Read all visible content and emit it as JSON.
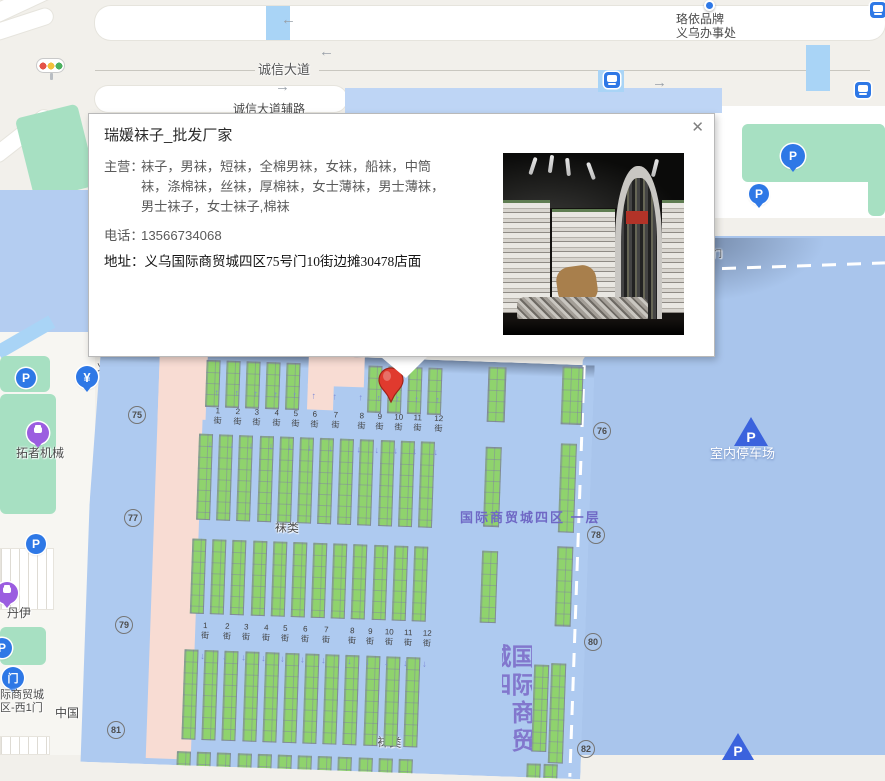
{
  "popup": {
    "title": "瑞媛袜子_批发厂家",
    "close_label": "✕",
    "fields": [
      {
        "label": "主营：",
        "value": "袜子，男袜，短袜，全棉男袜，女袜，船袜，中筒袜，涤棉袜，丝袜，厚棉袜，女士薄袜，男士薄袜，男士袜子，女士袜子,棉袜"
      },
      {
        "label": "电话：",
        "value": "13566734068"
      },
      {
        "label": "地址：",
        "value": "义乌国际商贸城四区75号门10街边摊30478店面"
      }
    ]
  },
  "map": {
    "streets": {
      "suffix": "街",
      "nums": [
        "1",
        "2",
        "3",
        "4",
        "5",
        "6",
        "7",
        "8",
        "9",
        "10",
        "11",
        "12"
      ],
      "rows": [
        {
          "v": 54,
          "us": [
            124,
            144,
            163,
            183,
            202,
            221,
            242,
            268,
            286,
            305,
            324,
            345
          ]
        },
        {
          "v": 269,
          "us": [
            119,
            141,
            160,
            180,
            199,
            219,
            240,
            266,
            284,
            303,
            322,
            341
          ]
        }
      ]
    },
    "street_arrows": [
      {
        "v": 36,
        "dir": "↑",
        "us": [
          124,
          144,
          163,
          183,
          202,
          221,
          242,
          268,
          286,
          305,
          324,
          345
        ]
      },
      {
        "v": 88,
        "dir": "↓",
        "us": [
          119,
          141,
          160,
          180,
          199,
          219,
          240,
          268,
          286,
          305,
          324,
          345
        ]
      },
      {
        "v": 300,
        "dir": "↓",
        "us": [
          119,
          141,
          160,
          180,
          199,
          219,
          240,
          266,
          284,
          303,
          322,
          341
        ]
      }
    ],
    "stall_bands": [
      {
        "v": 8,
        "h": 47,
        "w": 14,
        "cols": [
          112,
          132,
          152,
          172,
          192,
          274,
          294,
          314,
          334
        ]
      },
      {
        "v": 5,
        "h": 55,
        "w": 18,
        "cols": [
          394
        ]
      },
      {
        "v": 2,
        "h": 58,
        "w": 21,
        "cols": [
          468
        ]
      },
      {
        "v": 82,
        "h": 86,
        "w": 14,
        "cols": [
          107,
          127,
          147,
          168,
          188,
          208,
          228,
          248,
          268,
          289,
          309,
          329
        ]
      },
      {
        "v": 85,
        "h": 80,
        "w": 16,
        "cols": [
          394
        ]
      },
      {
        "v": 79,
        "h": 89,
        "w": 16,
        "cols": [
          469
        ]
      },
      {
        "v": 187,
        "h": 75,
        "w": 14,
        "cols": [
          104,
          124,
          144,
          165,
          185,
          205,
          225,
          245,
          265,
          286,
          306,
          326
        ]
      },
      {
        "v": 189,
        "h": 72,
        "w": 16,
        "cols": [
          394
        ]
      },
      {
        "v": 182,
        "h": 80,
        "w": 16,
        "cols": [
          469
        ]
      },
      {
        "v": 298,
        "h": 90,
        "w": 14,
        "cols": [
          100,
          120,
          140,
          161,
          181,
          201,
          221,
          241,
          261,
          282,
          302,
          322
        ]
      },
      {
        "v": 301,
        "h": 87,
        "w": 15,
        "cols": [
          450
        ]
      },
      {
        "v": 299,
        "h": 100,
        "w": 15,
        "cols": [
          467
        ]
      },
      {
        "v": 400,
        "h": 16,
        "w": 14,
        "cols": [
          96,
          116,
          136,
          157,
          177,
          197,
          217,
          237,
          257,
          278,
          298,
          318,
          446,
          463
        ]
      }
    ],
    "gates": [
      {
        "n": "75",
        "x": 128,
        "y": 406
      },
      {
        "n": "76",
        "x": 593,
        "y": 422
      },
      {
        "n": "77",
        "x": 124,
        "y": 509
      },
      {
        "n": "78",
        "x": 587,
        "y": 526
      },
      {
        "n": "79",
        "x": 115,
        "y": 616
      },
      {
        "n": "80",
        "x": 584,
        "y": 633
      },
      {
        "n": "81",
        "x": 107,
        "y": 721
      },
      {
        "n": "82",
        "x": 577,
        "y": 740
      }
    ],
    "features": [
      {
        "l": "u",
        "t": "road",
        "b": [
          95,
          6,
          790,
          34
        ],
        "name": "road-chengxin-avenue"
      },
      {
        "l": "u",
        "t": "crossing",
        "b": [
          266,
          6,
          24,
          34
        ],
        "name": "crosswalk"
      },
      {
        "l": "u",
        "t": "roadline",
        "b": [
          95,
          70,
          775,
          1
        ],
        "name": "road-centerline"
      },
      {
        "l": "u",
        "t": "road",
        "b": [
          95,
          86,
          252,
          26
        ],
        "name": "road-frontage"
      },
      {
        "l": "u",
        "t": "road",
        "b": [
          -14,
          -8,
          74,
          18
        ],
        "rot": -25,
        "name": "road-fragment"
      },
      {
        "l": "u",
        "t": "road",
        "b": [
          -10,
          16,
          64,
          16
        ],
        "rot": -18,
        "name": "road-fragment"
      },
      {
        "l": "u",
        "t": "road",
        "b": [
          -16,
          128,
          74,
          16
        ],
        "rot": -38,
        "name": "road-fragment"
      },
      {
        "l": "u",
        "t": "green",
        "b": [
          24,
          110,
          64,
          84
        ],
        "rot": -14,
        "name": "park-area"
      },
      {
        "l": "u",
        "t": "bldgL",
        "b": [
          0,
          190,
          88,
          143
        ],
        "name": "building-west"
      },
      {
        "l": "u",
        "t": "strip",
        "b": [
          0,
          332,
          95,
          423
        ],
        "name": "west-road-strip"
      },
      {
        "l": "u",
        "t": "crossing",
        "b": [
          -6,
          330,
          62,
          14
        ],
        "rot": -30,
        "name": "crosswalk"
      },
      {
        "l": "u",
        "t": "green",
        "b": [
          0,
          356,
          50,
          36
        ],
        "name": "green-area"
      },
      {
        "l": "u",
        "t": "green",
        "b": [
          0,
          394,
          56,
          120
        ],
        "name": "park-tuozhe"
      },
      {
        "l": "u",
        "t": "parking",
        "b": [
          0,
          548,
          54,
          62
        ],
        "name": "parking-lot"
      },
      {
        "l": "u",
        "t": "green",
        "b": [
          0,
          627,
          46,
          38
        ],
        "name": "green-area"
      },
      {
        "l": "u",
        "t": "parking",
        "b": [
          0,
          736,
          50,
          19
        ],
        "name": "parking-lot"
      },
      {
        "l": "u",
        "t": "roadsq",
        "b": [
          713,
          106,
          172,
          112
        ],
        "name": "road-northeast"
      },
      {
        "l": "u",
        "t": "green",
        "b": [
          742,
          124,
          143,
          58
        ],
        "name": "green-area-ne"
      },
      {
        "l": "u",
        "t": "green",
        "b": [
          868,
          124,
          17,
          92
        ],
        "name": "green-area-ne"
      },
      {
        "l": "u",
        "t": "bldg",
        "b": [
          345,
          88,
          377,
          25
        ],
        "name": "building-north"
      },
      {
        "l": "u",
        "t": "crossing",
        "b": [
          598,
          70,
          26,
          22
        ],
        "name": "crosswalk"
      },
      {
        "l": "u",
        "t": "crossing",
        "b": [
          806,
          45,
          24,
          46
        ],
        "name": "crosswalk"
      },
      {
        "l": "u",
        "t": "eastb",
        "b": [
          558,
          236,
          327,
          519
        ],
        "name": "building-east-parking"
      },
      {
        "l": "u",
        "t": "eshadow",
        "b": [
          560,
          238,
          325,
          110
        ],
        "name": "building-shadow"
      },
      {
        "l": "u",
        "t": "dashh",
        "b": [
          622,
          266,
          263,
          3
        ],
        "rot": -2,
        "name": "boundary-dashed-line"
      },
      {
        "l": "u",
        "t": "lbl",
        "b": [
          96,
          362,
          14,
          13
        ],
        "text": "义",
        "fs": 11,
        "name": "poi-label-partial"
      },
      {
        "l": "u",
        "t": "lbl",
        "b": [
          97,
          376,
          14,
          13
        ],
        "text": "钅",
        "fs": 11,
        "name": "poi-label-partial"
      },
      {
        "l": "u",
        "t": "lbl",
        "b": [
          55,
          706,
          30,
          14
        ],
        "text": "中国",
        "fs": 12,
        "name": "road-label-partial"
      },
      {
        "l": "m",
        "t": "mshadow",
        "b": [
          6,
          0,
          494,
          13
        ],
        "name": "market-top-shadow"
      },
      {
        "l": "m",
        "t": "pink",
        "b": [
          65,
          4,
          45,
          404
        ],
        "name": "market-pink-zone"
      },
      {
        "l": "m",
        "t": "pink",
        "b": [
          65,
          4,
          48,
          64
        ],
        "name": "market-pink-zone"
      },
      {
        "l": "m",
        "t": "pink",
        "b": [
          214,
          0,
          56,
          30
        ],
        "name": "market-pink-zone"
      },
      {
        "l": "m",
        "t": "pink",
        "b": [
          214,
          28,
          26,
          26
        ],
        "name": "market-pink-zone"
      },
      {
        "l": "m",
        "t": "dashv",
        "b": [
          488,
          0,
          3,
          412
        ],
        "name": "boundary-dashed-line"
      },
      {
        "l": "m",
        "t": "lbl",
        "b": [
          186,
          166,
          30,
          14
        ],
        "text": "袜类",
        "fs": 12,
        "name": "zone-label-socks"
      },
      {
        "l": "m",
        "t": "lbl",
        "b": [
          296,
          377,
          30,
          14
        ],
        "text": "袜类",
        "fs": 12,
        "name": "zone-label-socks"
      },
      {
        "l": "o",
        "t": "lblp",
        "b": [
          460,
          510,
          150,
          16
        ],
        "text": "国际商贸城四区  一层",
        "fs": 13,
        "name": "hall-label-district4-floor1"
      },
      {
        "l": "o",
        "t": "vtext",
        "b": [
          502,
          644,
          30,
          112
        ],
        "text": "国际商贸城四",
        "fs": 24,
        "name": "hall-label-vertical"
      },
      {
        "l": "o",
        "t": "lbl",
        "b": [
          690,
          249,
          48,
          12
        ],
        "text": "北5号门",
        "fs": 9,
        "name": "gate-label-north5"
      },
      {
        "l": "o",
        "t": "lbl",
        "b": [
          676,
          12,
          62,
          30
        ],
        "text": "珞依品牌\n义乌办事处",
        "fs": 12,
        "name": "poi-label-luoyi"
      },
      {
        "l": "o",
        "t": "poidot",
        "b": [
          704,
          0,
          11,
          11
        ],
        "i": true,
        "name": "poi-dot-icon"
      },
      {
        "l": "o",
        "t": "busicon",
        "b": [
          870,
          2,
          16,
          16
        ],
        "i": true,
        "name": "bus-stop-icon"
      },
      {
        "l": "o",
        "t": "busicon",
        "b": [
          855,
          82,
          16,
          16
        ],
        "i": true,
        "name": "bus-stop-icon"
      },
      {
        "l": "o",
        "t": "busicon",
        "b": [
          604,
          72,
          16,
          16
        ],
        "i": true,
        "name": "bus-stop-icon"
      },
      {
        "l": "o",
        "t": "arrow",
        "b": [
          281,
          12,
          16,
          16
        ],
        "text": "←",
        "name": "road-direction-arrow"
      },
      {
        "l": "o",
        "t": "arrow",
        "b": [
          319,
          44,
          16,
          16
        ],
        "text": "←",
        "name": "road-direction-arrow"
      },
      {
        "l": "o",
        "t": "arrow",
        "b": [
          275,
          79,
          16,
          16
        ],
        "text": "→",
        "name": "road-direction-arrow"
      },
      {
        "l": "o",
        "t": "arrow",
        "b": [
          652,
          75,
          16,
          16
        ],
        "text": "→",
        "name": "road-direction-arrow"
      },
      {
        "l": "o",
        "t": "lblroad",
        "b": [
          255,
          62,
          64,
          16
        ],
        "text": "诚信大道",
        "fs": 13,
        "name": "road-label-chengxin"
      },
      {
        "l": "o",
        "t": "lbl",
        "b": [
          233,
          102,
          80,
          14
        ],
        "text": "诚信大道辅路",
        "fs": 12,
        "name": "road-label-frontage"
      },
      {
        "l": "o",
        "t": "tl",
        "b": [
          36,
          58,
          29,
          15
        ],
        "i": true,
        "name": "traffic-light-icon"
      },
      {
        "l": "o",
        "t": "yen",
        "b": [
          76,
          366,
          22,
          22
        ],
        "text": "¥",
        "i": true,
        "name": "bank-icon"
      },
      {
        "l": "o",
        "t": "pcircle",
        "b": [
          16,
          368,
          20,
          20
        ],
        "text": "P",
        "i": true,
        "name": "parking-icon"
      },
      {
        "l": "o",
        "t": "pcircle",
        "b": [
          26,
          534,
          20,
          20
        ],
        "text": "P",
        "i": true,
        "name": "parking-icon"
      },
      {
        "l": "o",
        "t": "pcircle",
        "b": [
          -8,
          638,
          20,
          20
        ],
        "text": "P",
        "i": true,
        "name": "parking-icon"
      },
      {
        "l": "o",
        "t": "pcirclet",
        "b": [
          781,
          144,
          24,
          24
        ],
        "text": "P",
        "i": true,
        "name": "parking-icon"
      },
      {
        "l": "o",
        "t": "pcirclet",
        "b": [
          749,
          184,
          20,
          20
        ],
        "text": "P",
        "i": true,
        "name": "parking-icon"
      },
      {
        "l": "o",
        "t": "bag",
        "b": [
          27,
          422,
          22,
          22
        ],
        "i": true,
        "name": "shop-icon"
      },
      {
        "l": "o",
        "t": "lbl",
        "b": [
          16,
          446,
          52,
          14
        ],
        "text": "拓者机械",
        "fs": 12,
        "name": "poi-label-tuozhe"
      },
      {
        "l": "o",
        "t": "bag",
        "b": [
          -4,
          582,
          22,
          22
        ],
        "i": true,
        "name": "shop-icon"
      },
      {
        "l": "o",
        "t": "lbl",
        "b": [
          7,
          606,
          28,
          14
        ],
        "text": "丹伊",
        "fs": 12,
        "name": "poi-label-danyi"
      },
      {
        "l": "o",
        "t": "gateic",
        "b": [
          2,
          667,
          22,
          22
        ],
        "text": "门",
        "i": true,
        "name": "gate-icon-west1"
      },
      {
        "l": "o",
        "t": "lbl",
        "b": [
          0,
          689,
          54,
          26
        ],
        "text": "际商贸城\n区-西1门",
        "fs": 11,
        "name": "gate-label-west1"
      },
      {
        "l": "o",
        "t": "ptri",
        "b": [
          734,
          417,
          34,
          29
        ],
        "text": "P",
        "i": true,
        "name": "indoor-parking-icon"
      },
      {
        "l": "o",
        "t": "lblw",
        "b": [
          710,
          446,
          84,
          16
        ],
        "text": "室内停车场",
        "fs": 13,
        "name": "indoor-parking-label"
      },
      {
        "l": "o",
        "t": "ptri",
        "b": [
          722,
          733,
          32,
          27
        ],
        "text": "P",
        "i": true,
        "name": "indoor-parking-icon"
      }
    ]
  }
}
